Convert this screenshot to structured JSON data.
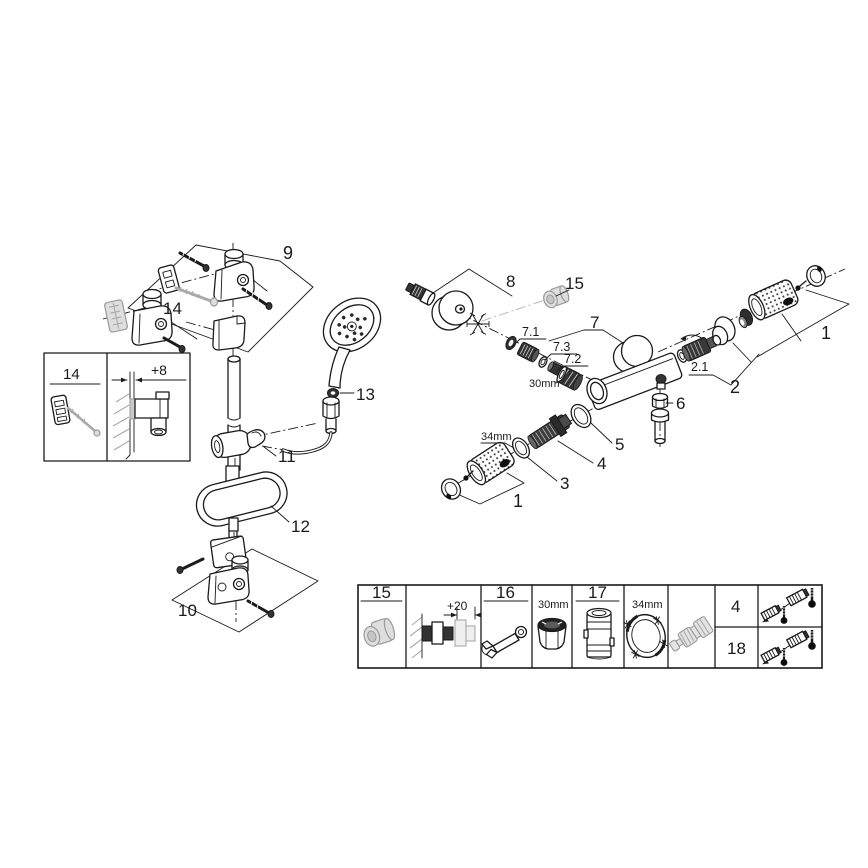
{
  "canvas": {
    "background": "#ffffff",
    "ink": "#1a1a1a",
    "grey": "#aaaaaa"
  },
  "left_assembly": {
    "callout_9": "9",
    "wallplug_label": "14",
    "oring_label": "13",
    "holder_label": "11",
    "tray_label": "12",
    "callout_10": "10",
    "inset": {
      "part_label": "14",
      "offset_label": "+8"
    }
  },
  "right_assembly": {
    "callout_8": "8",
    "cap_label": "15",
    "callout_7": "7",
    "sub_7_1": "7.1",
    "sub_7_3": "7.3",
    "sub_7_2": "7.2",
    "wrench_30": "30mm",
    "callout_1_upper": "1",
    "sub_2_1": "2.1",
    "callout_2": "2",
    "nut_label": "6",
    "ring5_label": "5",
    "spindle_label": "4",
    "ring3_label": "3",
    "wrench_34": "34mm",
    "callout_1_lower": "1"
  },
  "parts_table": {
    "cell_15": "15",
    "offset_20": "+20",
    "cell_16": "16",
    "size_30": "30mm",
    "cell_17": "17",
    "size_34": "34mm",
    "row_4": "4",
    "row_18": "18"
  }
}
